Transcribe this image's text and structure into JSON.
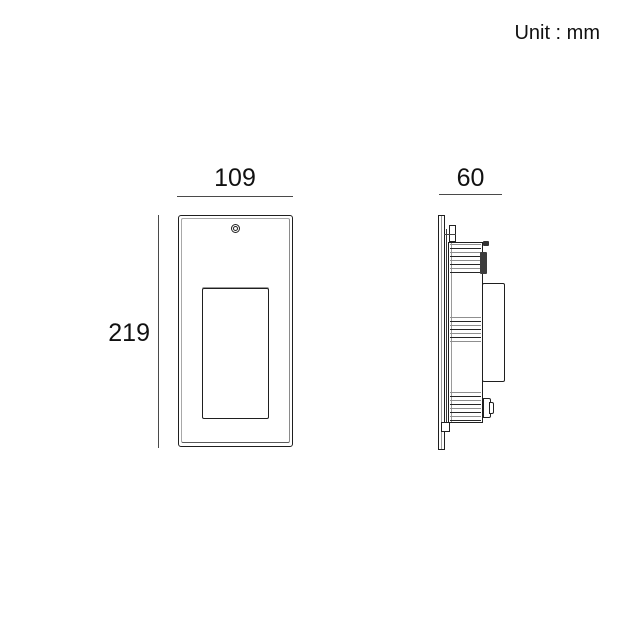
{
  "header": {
    "unit_label": "Unit : mm"
  },
  "drawing": {
    "title": "recessed wall light dimensional drawing",
    "front_view": {
      "width_mm": "109",
      "height_mm": "219"
    },
    "side_view": {
      "depth_mm": "60"
    }
  },
  "colors": {
    "background": "#ffffff",
    "outline": "#1f1f1f",
    "dimension_line": "#4a4a4a",
    "shading_gray": "#9a9a9a",
    "text": "#111111"
  }
}
